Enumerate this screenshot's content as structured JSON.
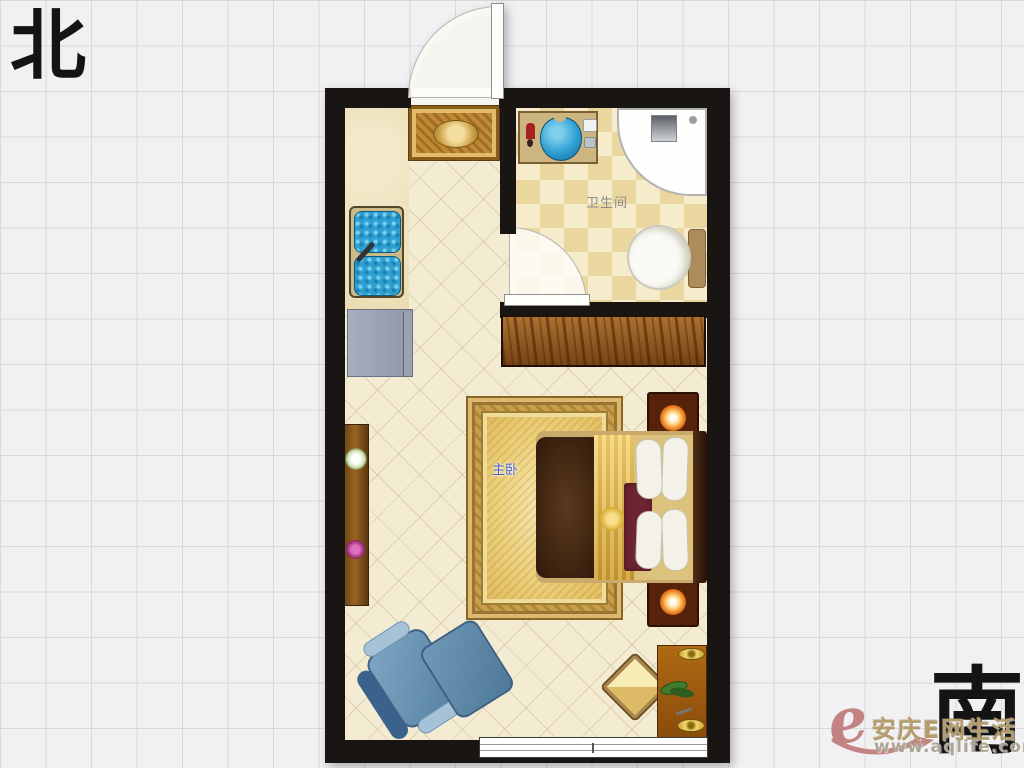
{
  "page": {
    "background": "#f1f1f3",
    "grid_color": "#d9d9dd",
    "grid_size_px": 45.5
  },
  "compass": {
    "north": "北",
    "south": "南",
    "color": "#141414"
  },
  "floorplan": {
    "wall_color": "#181512",
    "floor_color": "#f3ecd2",
    "bathroom_tile_colors": [
      "#f6eccb",
      "#ead79f"
    ],
    "labels": {
      "bathroom": "卫生间",
      "bedroom": "主卧"
    },
    "label_colors": {
      "bathroom": "#8d8d8d",
      "bedroom": "#4a62c8"
    },
    "rooms": [
      {
        "name": "main-room",
        "label": ""
      },
      {
        "name": "bathroom",
        "label": "卫生间"
      },
      {
        "name": "master-bedroom-zone",
        "label": "主卧"
      }
    ],
    "furniture": [
      "entry-door",
      "entrance-rug",
      "kitchen-counter",
      "kitchen-sink",
      "refrigerator",
      "wardrobe",
      "bathroom-vanity",
      "wash-basin",
      "shower-cabin",
      "toilet",
      "bathroom-door",
      "bedroom-rug",
      "double-bed",
      "nightstand-with-lamp-top",
      "nightstand-with-lamp-bottom",
      "console-table",
      "flower-white",
      "flower-purple",
      "armchair",
      "ottoman",
      "floor-cushion",
      "desk-with-plant",
      "window"
    ]
  },
  "watermark": {
    "logo_letter": "e",
    "site_name": "安庆E网生活",
    "site_url": "www.aqlife.com",
    "logo_color": "#c48383",
    "text_color": "#b49c6c",
    "url_color": "#aba695"
  }
}
